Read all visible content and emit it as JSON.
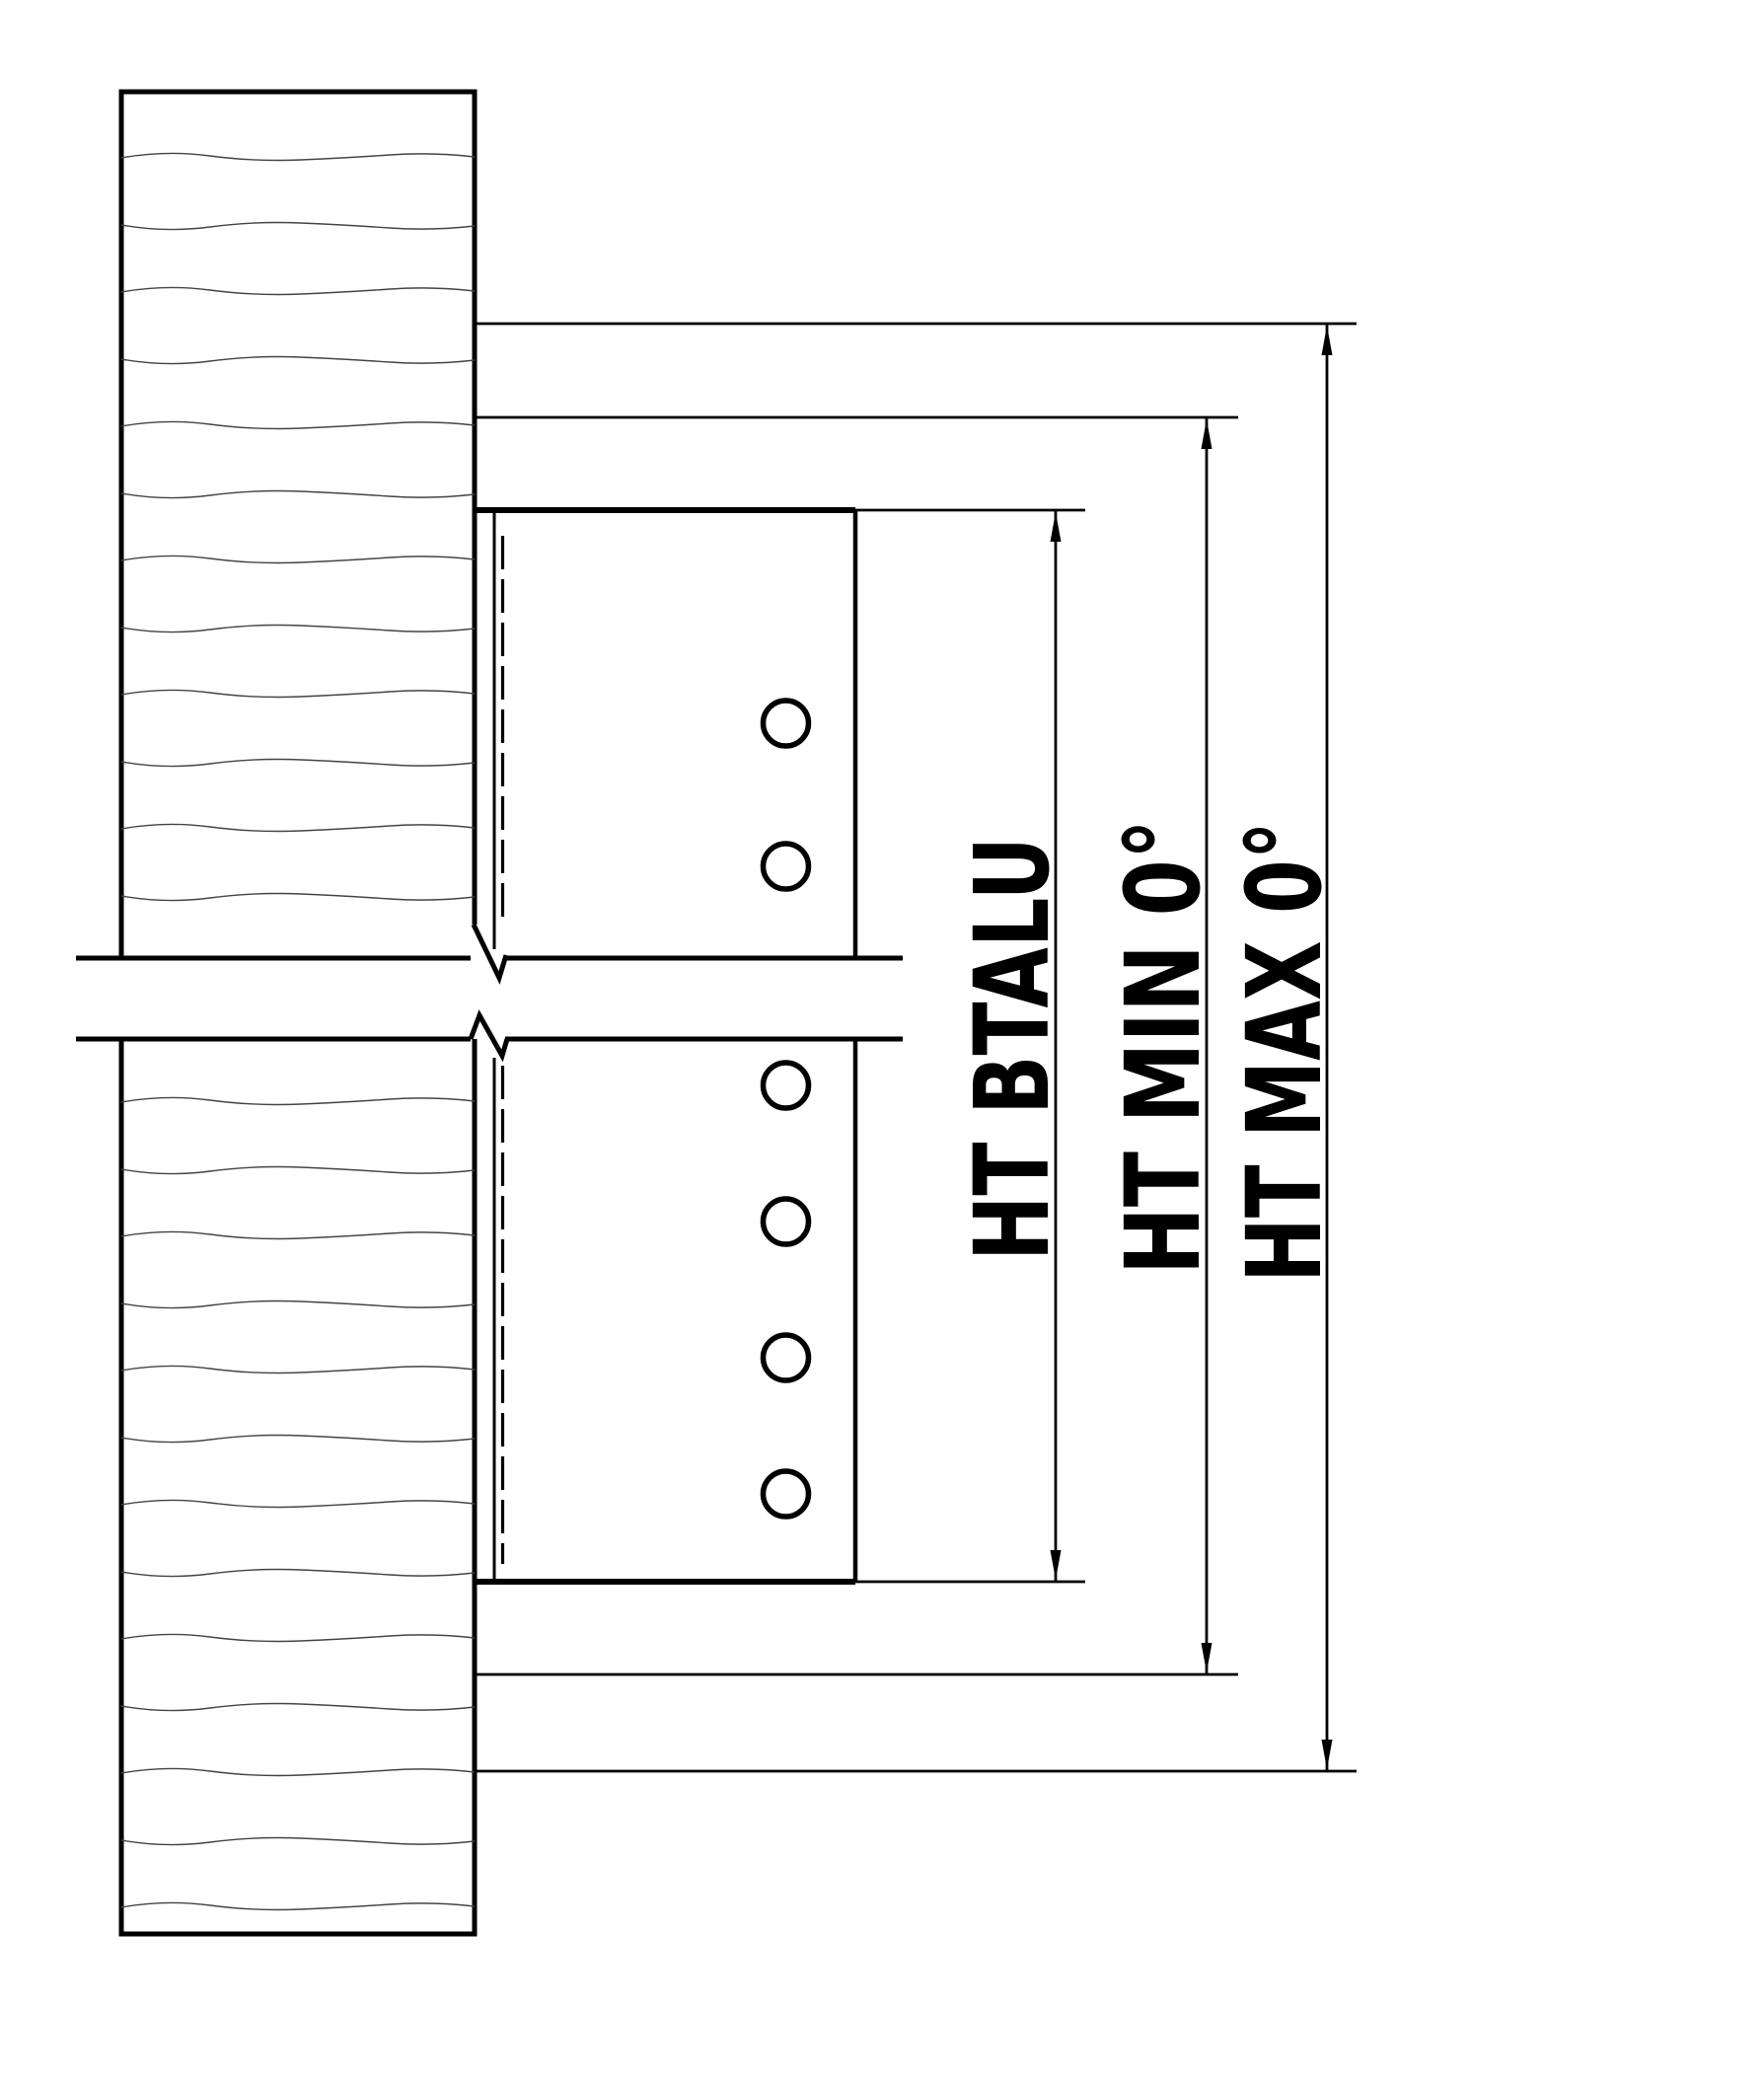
{
  "canvas": {
    "background": "#ffffff",
    "ink": "#000000",
    "grain_ink": "#444444"
  },
  "drawing": {
    "kind": "hinge-mounting-section",
    "dimension_labels": [
      {
        "id": "btalu",
        "label": "HT BTALU"
      },
      {
        "id": "min",
        "label": "HT MIN 0°"
      },
      {
        "id": "max",
        "label": "HT MAX 0°"
      }
    ]
  }
}
